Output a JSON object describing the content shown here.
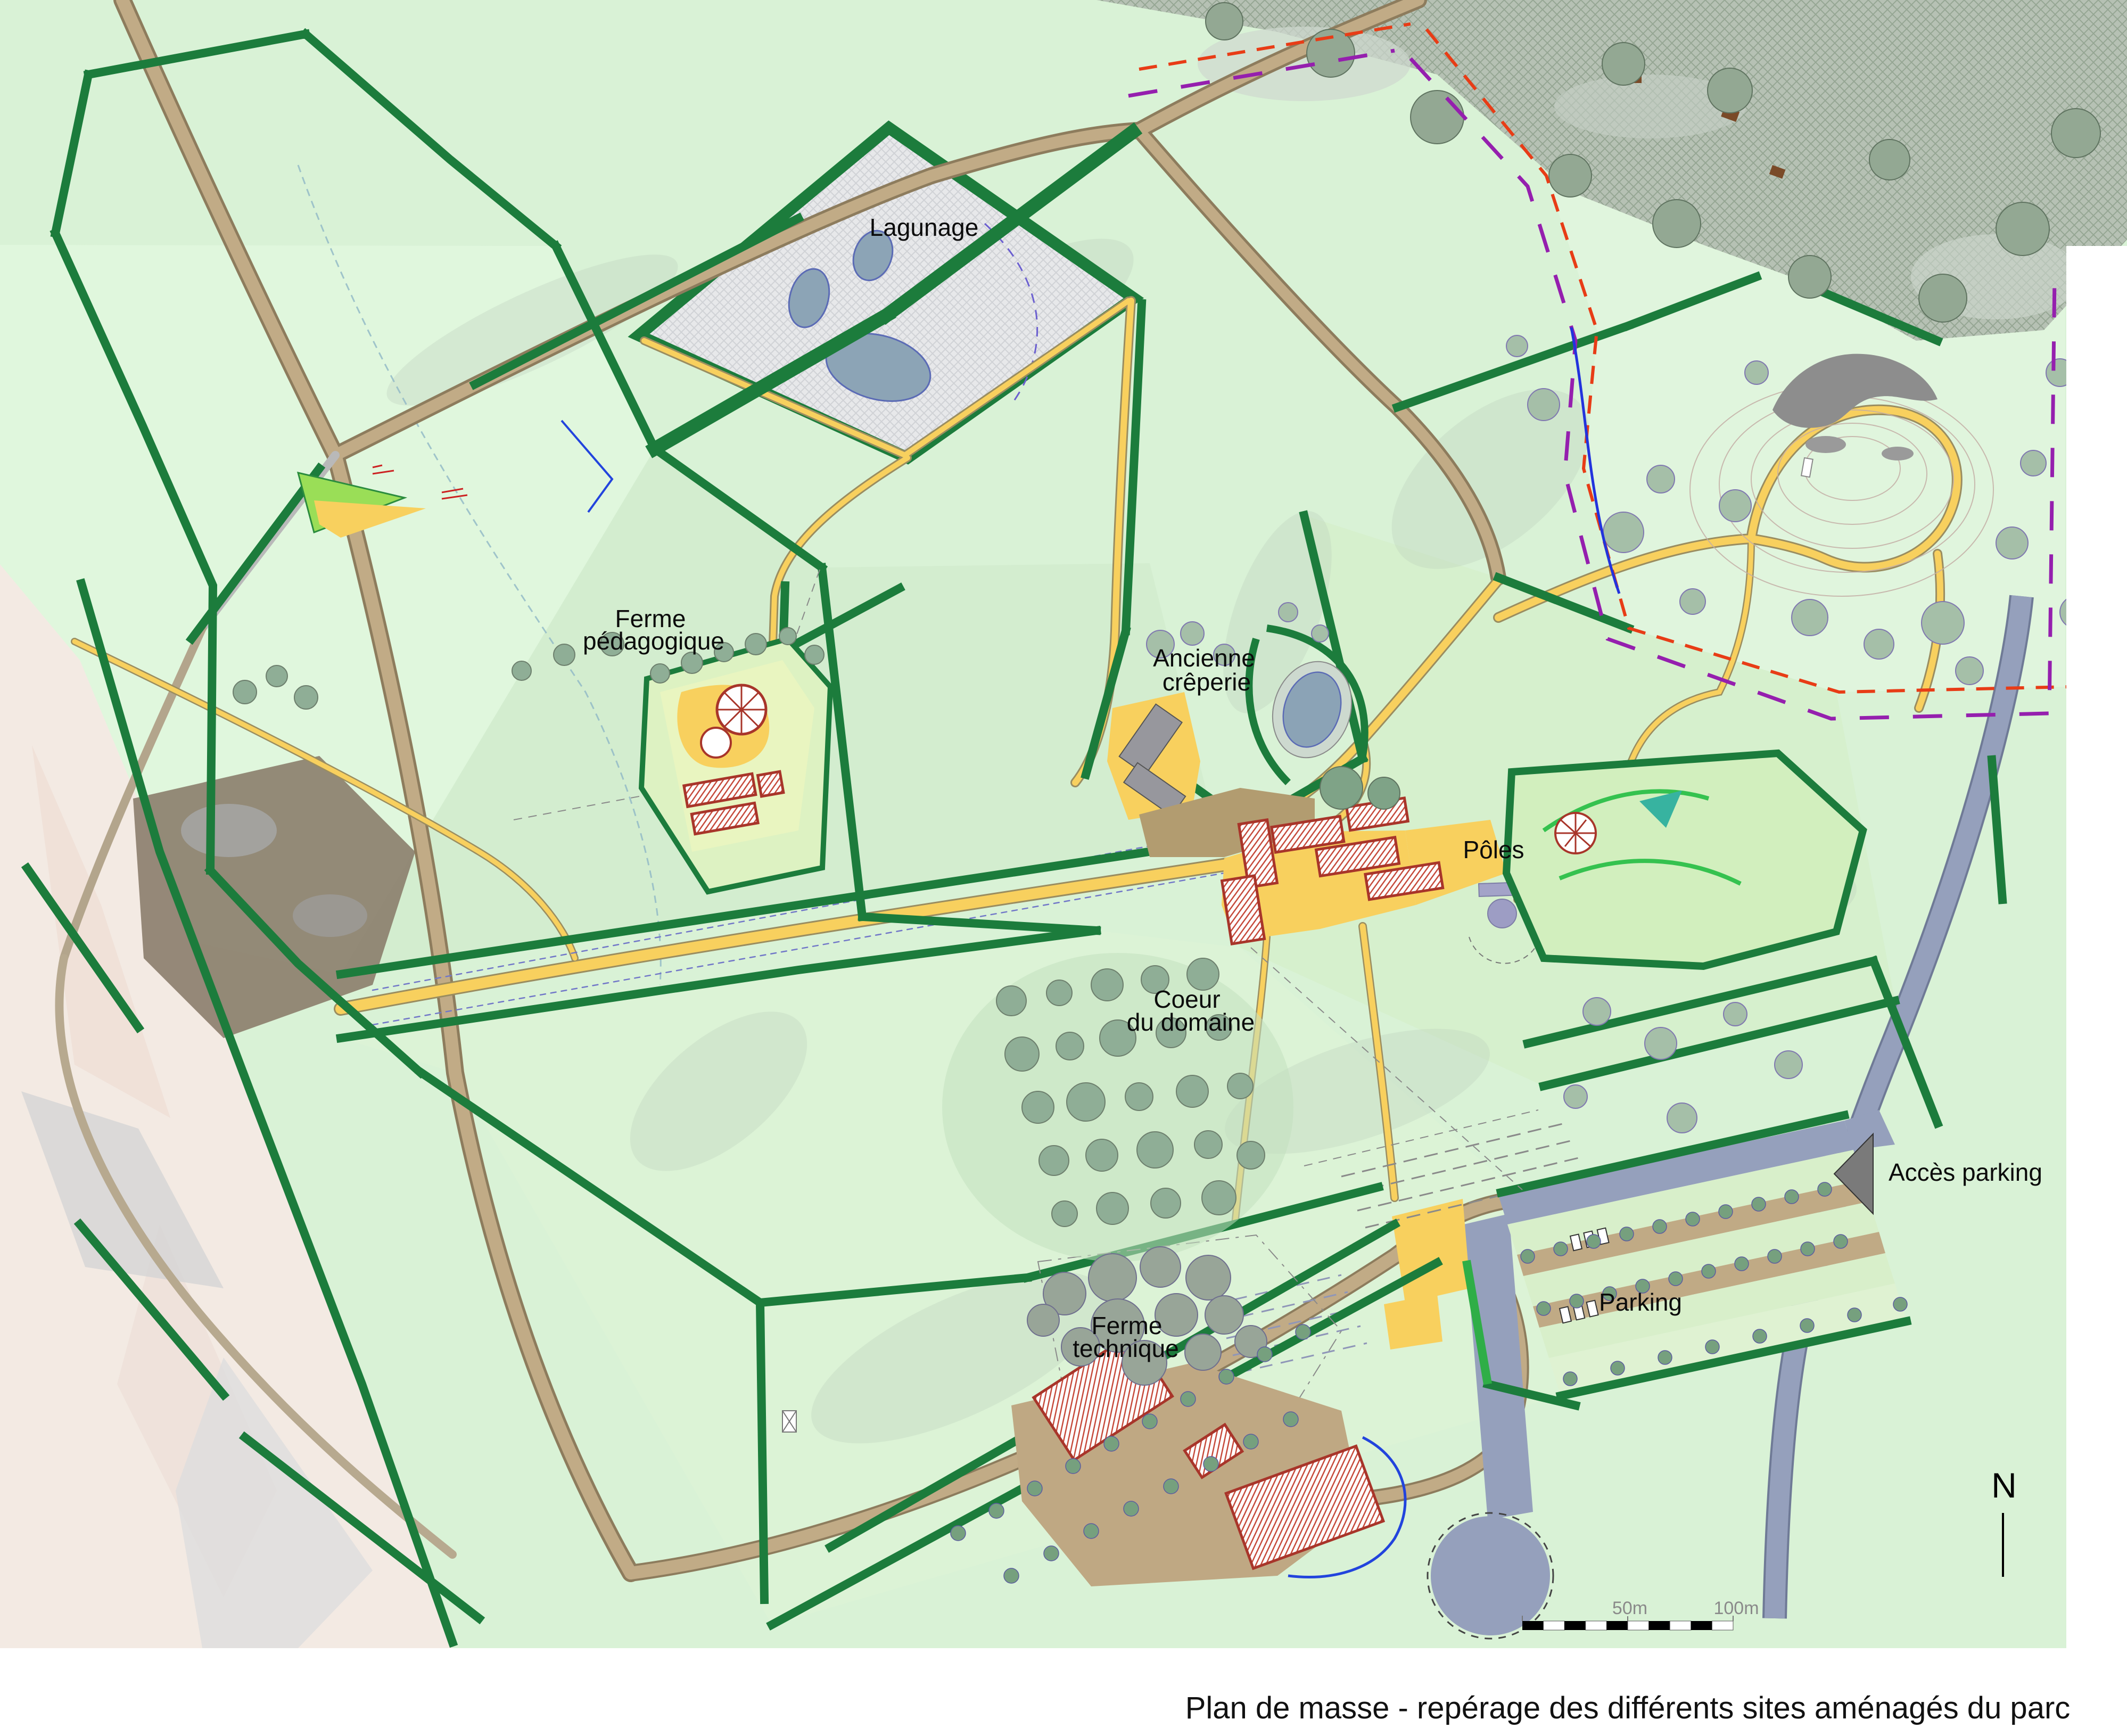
{
  "map": {
    "title": "Plan de masse - repérage des différents sites aménagés du parc",
    "north_label": "N",
    "scale_bar": {
      "mid_label": "50m",
      "end_label": "100m"
    },
    "sites": {
      "lagunage": {
        "label": "Lagunage"
      },
      "ferme_pedagogique": {
        "line1": "Ferme",
        "line2": "pédagogique"
      },
      "ancienne_creperie": {
        "line1": "Ancienne",
        "line2": "crêperie"
      },
      "poles": {
        "label": "Pôles"
      },
      "coeur_du_domaine": {
        "line1": "Coeur",
        "line2": "du domaine"
      },
      "acces_parking": {
        "label": "Accès parking"
      },
      "parking": {
        "label": "Parking"
      },
      "ferme_technique": {
        "line1": "Ferme",
        "line2": "technique"
      }
    },
    "colors": {
      "field_green": "#d9f2d6",
      "hedge_green": "#1c7c3c",
      "path_yellow": "#f8d05e",
      "road_tan": "#c1ab86",
      "road_slate": "#95a0bc",
      "water_blue_grey": "#8ca4b6",
      "building_red": "#ab352a",
      "forest_grey_green": "#b6c1b4",
      "boundary_red": "#e83c16",
      "boundary_purple": "#951fae",
      "outside_wash": "#f3eae3"
    }
  }
}
